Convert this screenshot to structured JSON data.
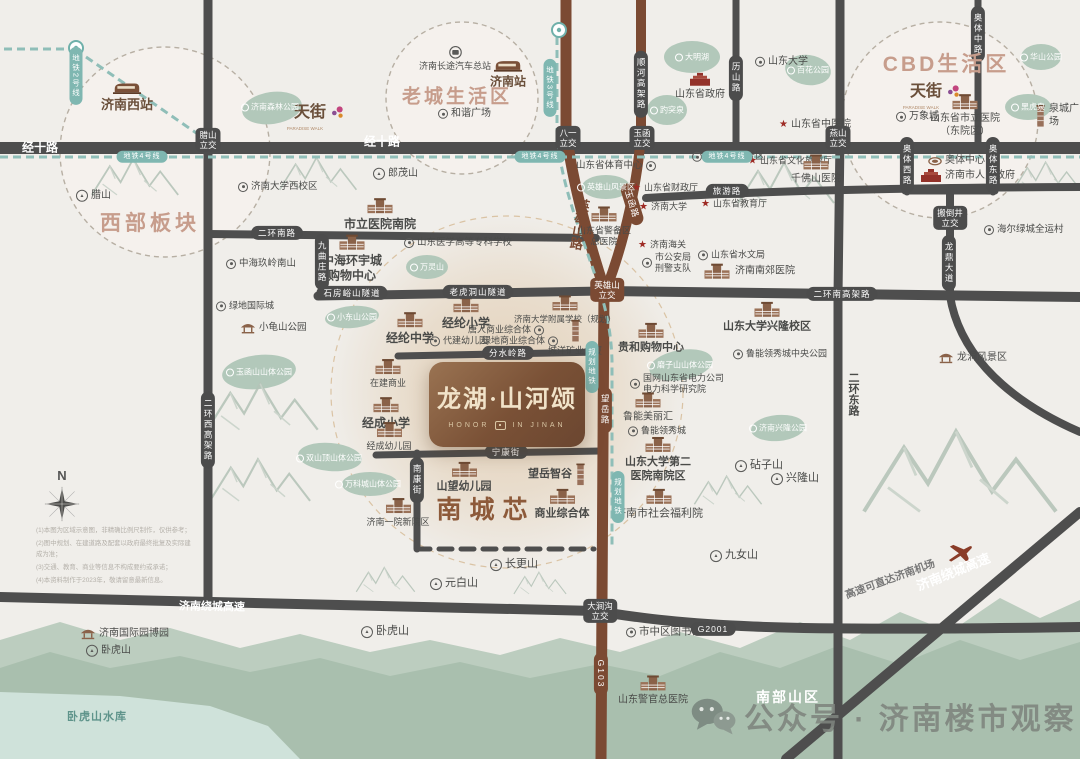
{
  "meta": {
    "width": 1080,
    "height": 759
  },
  "palette": {
    "bg": "#f0eeea",
    "road_gray": "#4e4e4e",
    "road_brown": "#7b4a33",
    "metro_teal": "#8fbeb8",
    "capsule_dark": "#4c4c4c",
    "capsule_brown": "#7b4a33",
    "capsule_teal": "#7fb7b1",
    "park_green": "#b2c8ba",
    "hill_back": "#bccdbf",
    "hill_front": "#a9bfae",
    "water": "#cfe2da",
    "title_rose": "#c79d8c",
    "brand_brown": "#8d5a3a",
    "station_brown": "#6a4f3a",
    "text_dark": "#4a4b49",
    "text_mid": "#787878",
    "text_muted": "#b08968",
    "white": "#ffffff",
    "teal_text": "#5f948b",
    "watermark_gray": "#7e847e",
    "star_red": "#9e2b25"
  },
  "brand": {
    "title": "龙湖·山河颂",
    "sub_left": "HONOR",
    "sub_right": "IN JINAN"
  },
  "watermark": {
    "text": "公众号 · 济南楼市观察"
  },
  "compass": {
    "label": "N"
  },
  "titles": [
    {
      "t": "西部板块",
      "x": 150,
      "y": 222,
      "s": 21,
      "k": "rose",
      "ls": 4
    },
    {
      "t": "老城生活区",
      "x": 457,
      "y": 95,
      "s": 19,
      "k": "rose",
      "ls": 3
    },
    {
      "t": "CBD生活区",
      "x": 946,
      "y": 63,
      "s": 21,
      "k": "rose",
      "ls": 3
    },
    {
      "t": "南城芯",
      "x": 486,
      "y": 508,
      "s": 25,
      "k": "brown2",
      "ls": 8
    },
    {
      "t": "南部山区",
      "x": 788,
      "y": 697,
      "s": 14,
      "k": "white",
      "ls": 2
    },
    {
      "t": "卧虎山水库",
      "x": 97,
      "y": 716,
      "s": 11,
      "k": "teal2",
      "ls": 1
    }
  ],
  "road_labels": [
    {
      "t": "经十路",
      "x": 40,
      "y": 147,
      "type": "rt",
      "s": 12
    },
    {
      "t": "经十路",
      "x": 382,
      "y": 141,
      "type": "rt",
      "s": 12
    },
    {
      "t": "济南绕城高速",
      "x": 212,
      "y": 606,
      "type": "rt",
      "s": 11,
      "rot": 1
    },
    {
      "t": "济南绕城高速",
      "x": 953,
      "y": 571,
      "type": "rt",
      "s": 13,
      "rot": -22
    },
    {
      "t": "高速可直达济南机场",
      "x": 890,
      "y": 579,
      "type": "rt",
      "s": 10.5,
      "rot": -20,
      "k": "mid"
    },
    {
      "t": "腊山\n立交",
      "x": 208,
      "y": 140,
      "type": "j"
    },
    {
      "t": "八一\n立交",
      "x": 568,
      "y": 138,
      "type": "j"
    },
    {
      "t": "玉函\n立交",
      "x": 642,
      "y": 138,
      "type": "j"
    },
    {
      "t": "燕山\n立交",
      "x": 838,
      "y": 138,
      "type": "j"
    },
    {
      "t": "搬倒井\n立交",
      "x": 950,
      "y": 218,
      "type": "j"
    },
    {
      "t": "大涧沟\n立交",
      "x": 600,
      "y": 611,
      "type": "j"
    },
    {
      "t": "英雄山\n立交",
      "x": 607,
      "y": 290,
      "type": "j",
      "k": "brown"
    },
    {
      "t": "二环南路",
      "x": 277,
      "y": 233,
      "type": "h"
    },
    {
      "t": "石房峪山隧道",
      "x": 352,
      "y": 293,
      "type": "h"
    },
    {
      "t": "老虎洞山隧道",
      "x": 478,
      "y": 292,
      "type": "h"
    },
    {
      "t": "二环南高架路",
      "x": 842,
      "y": 294,
      "type": "h"
    },
    {
      "t": "分水岭路",
      "x": 508,
      "y": 353,
      "type": "h"
    },
    {
      "t": "宁康街",
      "x": 506,
      "y": 452,
      "type": "h"
    },
    {
      "t": "旅游路",
      "x": 727,
      "y": 191,
      "type": "h"
    },
    {
      "t": "G2001",
      "x": 713,
      "y": 629,
      "type": "h"
    },
    {
      "t": "二环西高架路",
      "x": 208,
      "y": 430,
      "type": "v"
    },
    {
      "t": "九曲庄路",
      "x": 322,
      "y": 262,
      "type": "v"
    },
    {
      "t": "南康街",
      "x": 417,
      "y": 480,
      "type": "v"
    },
    {
      "t": "顺河高架路",
      "x": 641,
      "y": 84,
      "type": "v"
    },
    {
      "t": "历山路",
      "x": 736,
      "y": 78,
      "type": "v"
    },
    {
      "t": "奥体中路",
      "x": 978,
      "y": 34,
      "type": "v"
    },
    {
      "t": "奥体西路",
      "x": 907,
      "y": 165,
      "type": "v"
    },
    {
      "t": "奥体东路",
      "x": 993,
      "y": 165,
      "type": "v"
    },
    {
      "t": "龙鼎大道",
      "x": 949,
      "y": 263,
      "type": "v"
    },
    {
      "t": "望岳路",
      "x": 605,
      "y": 410,
      "type": "v",
      "k": "brown"
    },
    {
      "t": "G103",
      "x": 601,
      "y": 674,
      "type": "v",
      "k": "brown"
    },
    {
      "t": "玉函路",
      "x": 632,
      "y": 204,
      "type": "h",
      "rot": 73,
      "k": "brown"
    },
    {
      "t": "英雄山路",
      "x": 579,
      "y": 224,
      "type": "vt",
      "s": 13,
      "k": "brownText",
      "rot": 10
    },
    {
      "t": "二环东路",
      "x": 853,
      "y": 394,
      "type": "vt",
      "s": 11,
      "k": "dark",
      "rot": 0
    },
    {
      "t": "地铁2号线",
      "x": 76,
      "y": 76,
      "type": "v",
      "k": "teal",
      "s": 7.5
    },
    {
      "t": "地铁3号线",
      "x": 550,
      "y": 88,
      "type": "v",
      "k": "teal",
      "s": 7.5
    },
    {
      "t": "规划地铁",
      "x": 592,
      "y": 367,
      "type": "v",
      "k": "teal",
      "s": 7.5
    },
    {
      "t": "规划地铁",
      "x": 618,
      "y": 497,
      "type": "v",
      "k": "teal",
      "s": 7.5
    },
    {
      "t": "地铁4号线",
      "x": 142,
      "y": 157,
      "type": "h",
      "k": "teal",
      "s": 7
    },
    {
      "t": "地铁4号线",
      "x": 540,
      "y": 157,
      "type": "h",
      "k": "teal",
      "s": 7
    },
    {
      "t": "地铁4号线",
      "x": 727,
      "y": 157,
      "type": "h",
      "k": "teal",
      "s": 7
    }
  ],
  "pois": [
    {
      "t": "济南西站",
      "x": 127,
      "y": 97,
      "i": "train",
      "a": "c",
      "s": 13,
      "b": 1,
      "k": "brn"
    },
    {
      "t": "济南站",
      "x": 508,
      "y": 74,
      "i": "train",
      "a": "c",
      "s": 12,
      "b": 1,
      "k": "brn"
    },
    {
      "t": "济南长途汽车总站",
      "x": 455,
      "y": 59,
      "i": "bus",
      "a": "c",
      "s": 9
    },
    {
      "t": "和谐广场",
      "x": 438,
      "y": 114,
      "i": "circle",
      "a": "l",
      "s": 10
    },
    {
      "t": "山东大学",
      "x": 755,
      "y": 62,
      "i": "circle",
      "a": "l",
      "s": 10
    },
    {
      "t": "山东省政府",
      "x": 700,
      "y": 87,
      "i": "red",
      "a": "c",
      "s": 10
    },
    {
      "t": "泉城广场",
      "x": 1035,
      "y": 116,
      "i": "tower",
      "a": "l",
      "s": 10
    },
    {
      "t": "万象城",
      "x": 896,
      "y": 117,
      "i": "circle",
      "a": "l",
      "s": 10
    },
    {
      "t": "山东省市立医院\n（东院区）",
      "x": 965,
      "y": 116,
      "i": "bldg",
      "a": "c",
      "s": 10
    },
    {
      "t": "天街",
      "x": 294,
      "y": 113,
      "i": "flower",
      "a": "r",
      "s": 16,
      "b": 1,
      "k": "brn"
    },
    {
      "t": "PARADISE WALK",
      "x": 305,
      "y": 129,
      "i": "none",
      "a": "c",
      "s": 4.5,
      "k": "mut"
    },
    {
      "t": "天街",
      "x": 910,
      "y": 92,
      "i": "flower",
      "a": "r",
      "s": 16,
      "b": 1,
      "k": "brn"
    },
    {
      "t": "PARADISE WALK",
      "x": 921,
      "y": 108,
      "i": "none",
      "a": "c",
      "s": 4.5,
      "k": "mut"
    },
    {
      "t": "山东省中医院",
      "x": 779,
      "y": 125,
      "i": "star",
      "a": "l",
      "s": 10
    },
    {
      "t": "千佛山风景区",
      "x": 692,
      "y": 157,
      "i": "circle",
      "a": "l",
      "s": 10
    },
    {
      "t": "山东省文化旅游厅",
      "x": 748,
      "y": 161,
      "i": "star",
      "a": "l",
      "s": 9
    },
    {
      "t": "千佛山医院",
      "x": 816,
      "y": 170,
      "i": "bldg",
      "a": "c",
      "s": 10
    },
    {
      "t": "山东省教育厅",
      "x": 701,
      "y": 204,
      "i": "star",
      "a": "l",
      "s": 9
    },
    {
      "t": "山东省体育中心",
      "x": 576,
      "y": 166,
      "i": "circle",
      "a": "r",
      "s": 9.5
    },
    {
      "t": "山东省财政厅",
      "x": 632,
      "y": 188,
      "i": "star",
      "a": "l",
      "s": 9
    },
    {
      "t": "济南大学",
      "x": 639,
      "y": 207,
      "i": "star",
      "a": "l",
      "s": 9
    },
    {
      "t": "山东省警备区\n总医院",
      "x": 604,
      "y": 227,
      "i": "bldg",
      "a": "c",
      "s": 9
    },
    {
      "t": "济南海关",
      "x": 638,
      "y": 245,
      "i": "star",
      "a": "l",
      "s": 9
    },
    {
      "t": "市公安局\n刑警支队",
      "x": 642,
      "y": 263,
      "i": "circle",
      "a": "l",
      "s": 9
    },
    {
      "t": "山东省水文局",
      "x": 698,
      "y": 255,
      "i": "circle",
      "a": "l",
      "s": 9
    },
    {
      "t": "济南南郊医院",
      "x": 702,
      "y": 272,
      "i": "bldg",
      "a": "l",
      "s": 10
    },
    {
      "t": "奥体中心",
      "x": 928,
      "y": 161,
      "i": "stad",
      "a": "l",
      "s": 10
    },
    {
      "t": "济南市人民政府",
      "x": 920,
      "y": 176,
      "i": "red",
      "a": "l",
      "s": 10
    },
    {
      "t": "海尔绿城全运村",
      "x": 984,
      "y": 230,
      "i": "circle",
      "a": "l",
      "s": 9.5
    },
    {
      "t": "龙洞风景区",
      "x": 938,
      "y": 358,
      "i": "pav",
      "a": "l",
      "s": 10
    },
    {
      "t": "市立医院南院",
      "x": 380,
      "y": 215,
      "i": "bldg",
      "a": "c",
      "s": 12,
      "b": 1
    },
    {
      "t": "山东医学高等专科学校",
      "x": 404,
      "y": 243,
      "i": "circle",
      "a": "l",
      "s": 9.5
    },
    {
      "t": "中海环宇城\n购物中心",
      "x": 352,
      "y": 259,
      "i": "bldg",
      "a": "c",
      "s": 12,
      "b": 1
    },
    {
      "t": "中海玖岭南山",
      "x": 226,
      "y": 264,
      "i": "circle",
      "a": "l",
      "s": 9.5
    },
    {
      "t": "济南大学西校区",
      "x": 238,
      "y": 187,
      "i": "circle",
      "a": "l",
      "s": 9.5
    },
    {
      "t": "腊山",
      "x": 76,
      "y": 196,
      "i": "mtn",
      "a": "l",
      "s": 10
    },
    {
      "t": "郎茂山",
      "x": 373,
      "y": 174,
      "i": "mtn",
      "a": "l",
      "s": 10
    },
    {
      "t": "绿地国际城",
      "x": 216,
      "y": 306,
      "i": "circle",
      "a": "l",
      "s": 9
    },
    {
      "t": "小龟山公园",
      "x": 240,
      "y": 328,
      "i": "pav",
      "a": "l",
      "s": 9.5
    },
    {
      "t": "经纶小学",
      "x": 466,
      "y": 314,
      "i": "bldg",
      "a": "c",
      "s": 12,
      "b": 1
    },
    {
      "t": "经纶中学",
      "x": 410,
      "y": 329,
      "i": "bldg",
      "a": "c",
      "s": 12,
      "b": 1
    },
    {
      "t": "济南大学附属学校（规划）",
      "x": 565,
      "y": 310,
      "i": "bldg",
      "a": "c",
      "s": 8.5
    },
    {
      "t": "唐人商业综合体",
      "x": 468,
      "y": 330,
      "i": "circle",
      "a": "r",
      "s": 9
    },
    {
      "t": "绿地商业综合体",
      "x": 482,
      "y": 341,
      "i": "circle",
      "a": "r",
      "s": 9
    },
    {
      "t": "代建幼儿园",
      "x": 430,
      "y": 341,
      "i": "circle",
      "a": "l",
      "s": 9
    },
    {
      "t": "城洋矿业大厦",
      "x": 575,
      "y": 338,
      "i": "tower",
      "a": "c",
      "s": 9
    },
    {
      "t": "在建商业",
      "x": 388,
      "y": 374,
      "i": "bldg",
      "a": "c",
      "s": 9
    },
    {
      "t": "经成小学",
      "x": 386,
      "y": 414,
      "i": "bldg",
      "a": "c",
      "s": 12,
      "b": 1
    },
    {
      "t": "经成幼儿园",
      "x": 389,
      "y": 437,
      "i": "bldg",
      "a": "c",
      "s": 9
    },
    {
      "t": "济南一院新院区",
      "x": 398,
      "y": 513,
      "i": "bldg",
      "a": "c",
      "s": 9
    },
    {
      "t": "山望幼儿园",
      "x": 464,
      "y": 478,
      "i": "bldg",
      "a": "c",
      "s": 11,
      "b": 1
    },
    {
      "t": "望岳智谷",
      "x": 528,
      "y": 475,
      "i": "tower",
      "a": "r",
      "s": 11,
      "b": 1
    },
    {
      "t": "商业综合体",
      "x": 562,
      "y": 505,
      "i": "bldg",
      "a": "c",
      "s": 11,
      "b": 1
    },
    {
      "t": "贵和购物中心",
      "x": 651,
      "y": 339,
      "i": "bldg",
      "a": "c",
      "s": 11,
      "b": 1
    },
    {
      "t": "国网山东省电力公司\n电力科学研究院",
      "x": 630,
      "y": 384,
      "i": "circle",
      "a": "l",
      "s": 9
    },
    {
      "t": "鲁能美丽汇",
      "x": 648,
      "y": 408,
      "i": "bldg",
      "a": "c",
      "s": 10
    },
    {
      "t": "鲁能领秀城",
      "x": 628,
      "y": 431,
      "i": "circle",
      "a": "l",
      "s": 9
    },
    {
      "t": "山东大学第二\n医院南院区",
      "x": 658,
      "y": 460,
      "i": "bldg",
      "a": "c",
      "s": 11,
      "b": 1
    },
    {
      "t": "济南市社会福利院",
      "x": 659,
      "y": 505,
      "i": "bldg",
      "a": "c",
      "s": 11
    },
    {
      "t": "鲁能领秀城中央公园",
      "x": 733,
      "y": 354,
      "i": "circle",
      "a": "l",
      "s": 9
    },
    {
      "t": "山东大学兴隆校区",
      "x": 767,
      "y": 318,
      "i": "bldg",
      "a": "c",
      "s": 11,
      "b": 1
    },
    {
      "t": "砧子山",
      "x": 735,
      "y": 466,
      "i": "mtn",
      "a": "l",
      "s": 11
    },
    {
      "t": "兴隆山",
      "x": 771,
      "y": 479,
      "i": "mtn",
      "a": "l",
      "s": 11
    },
    {
      "t": "九女山",
      "x": 710,
      "y": 556,
      "i": "mtn",
      "a": "l",
      "s": 11
    },
    {
      "t": "元白山",
      "x": 430,
      "y": 584,
      "i": "mtn",
      "a": "l",
      "s": 11
    },
    {
      "t": "长更山",
      "x": 490,
      "y": 565,
      "i": "mtn",
      "a": "l",
      "s": 11
    },
    {
      "t": "卧虎山",
      "x": 361,
      "y": 632,
      "i": "mtn",
      "a": "l",
      "s": 11
    },
    {
      "t": "卧虎山",
      "x": 86,
      "y": 651,
      "i": "mtn",
      "a": "l",
      "s": 10
    },
    {
      "t": "济南国际园博园",
      "x": 80,
      "y": 634,
      "i": "pav",
      "a": "l",
      "s": 10
    },
    {
      "t": "市中区图书馆",
      "x": 626,
      "y": 632,
      "i": "circle",
      "a": "l",
      "s": 10.5
    },
    {
      "t": "山东警官总医院",
      "x": 653,
      "y": 691,
      "i": "bldg",
      "a": "c",
      "s": 10
    }
  ],
  "blobs": [
    {
      "t": "济南森林公园",
      "x": 270,
      "y": 107
    },
    {
      "t": "大明湖",
      "x": 692,
      "y": 57
    },
    {
      "t": "趵突泉",
      "x": 667,
      "y": 110
    },
    {
      "t": "百花公园",
      "x": 808,
      "y": 70
    },
    {
      "t": "黑虎泉",
      "x": 1028,
      "y": 107
    },
    {
      "t": "华山公园",
      "x": 1041,
      "y": 57
    },
    {
      "t": "英雄山风景区",
      "x": 606,
      "y": 187
    },
    {
      "t": "万灵山",
      "x": 427,
      "y": 267
    },
    {
      "t": "小东山公园",
      "x": 352,
      "y": 317
    },
    {
      "t": "玉函山山体公园",
      "x": 259,
      "y": 372
    },
    {
      "t": "双山顶山体公园",
      "x": 329,
      "y": 458
    },
    {
      "t": "万科城山体公园",
      "x": 368,
      "y": 484
    },
    {
      "t": "磨子山山体公园",
      "x": 680,
      "y": 365
    },
    {
      "t": "济南兴隆公园",
      "x": 778,
      "y": 428
    }
  ],
  "disclaimer": {
    "lines": [
      "(1)本图为区域示意图，非精确比例尺制作，仅供参考；",
      "(2)图中规划、在建道路及配套以政府最终批复及实际建成为准；",
      "(3)交通、教育、商业等信息不构成要约或承诺；",
      "(4)本资料制作于2023年，敬请留意最新信息。"
    ]
  }
}
